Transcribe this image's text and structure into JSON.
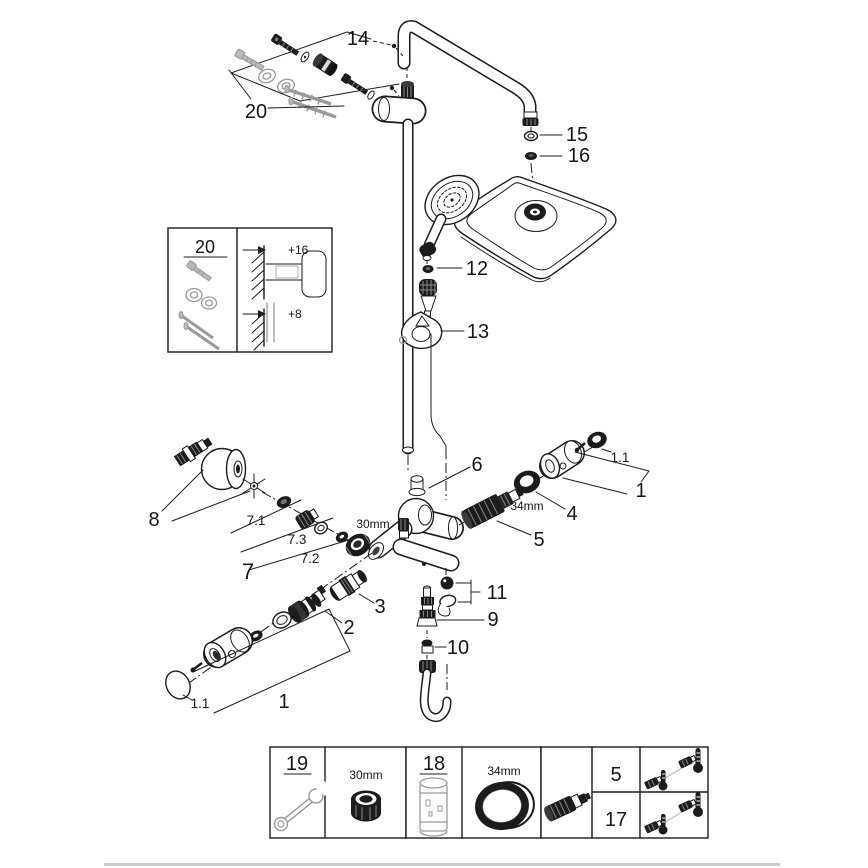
{
  "callouts": {
    "part14": "14",
    "part20_top": "20",
    "part15": "15",
    "part16": "16",
    "part12": "12",
    "part13": "13",
    "part8": "8",
    "part7": "7",
    "part7_1": "7.1",
    "part7_3": "7.3",
    "part7_2": "7.2",
    "part6": "6",
    "part5": "5",
    "part4": "4",
    "part1_right": "1",
    "part1_1_right": "1.1",
    "part11": "11",
    "part9": "9",
    "part10": "10",
    "part3": "3",
    "part2": "2",
    "part1_left": "1",
    "part1_1_left": "1.1"
  },
  "dimensions": {
    "nut_size": "30mm",
    "ring_size": "34mm"
  },
  "inset": {
    "title": "20",
    "offset_top": "+16",
    "offset_bottom": "+8"
  },
  "table": {
    "cell_19_label": "19",
    "cell_19_size": "30mm",
    "cell_18_label": "18",
    "cell_18_size": "34mm",
    "row_5_label": "5",
    "row_17_label": "17"
  }
}
